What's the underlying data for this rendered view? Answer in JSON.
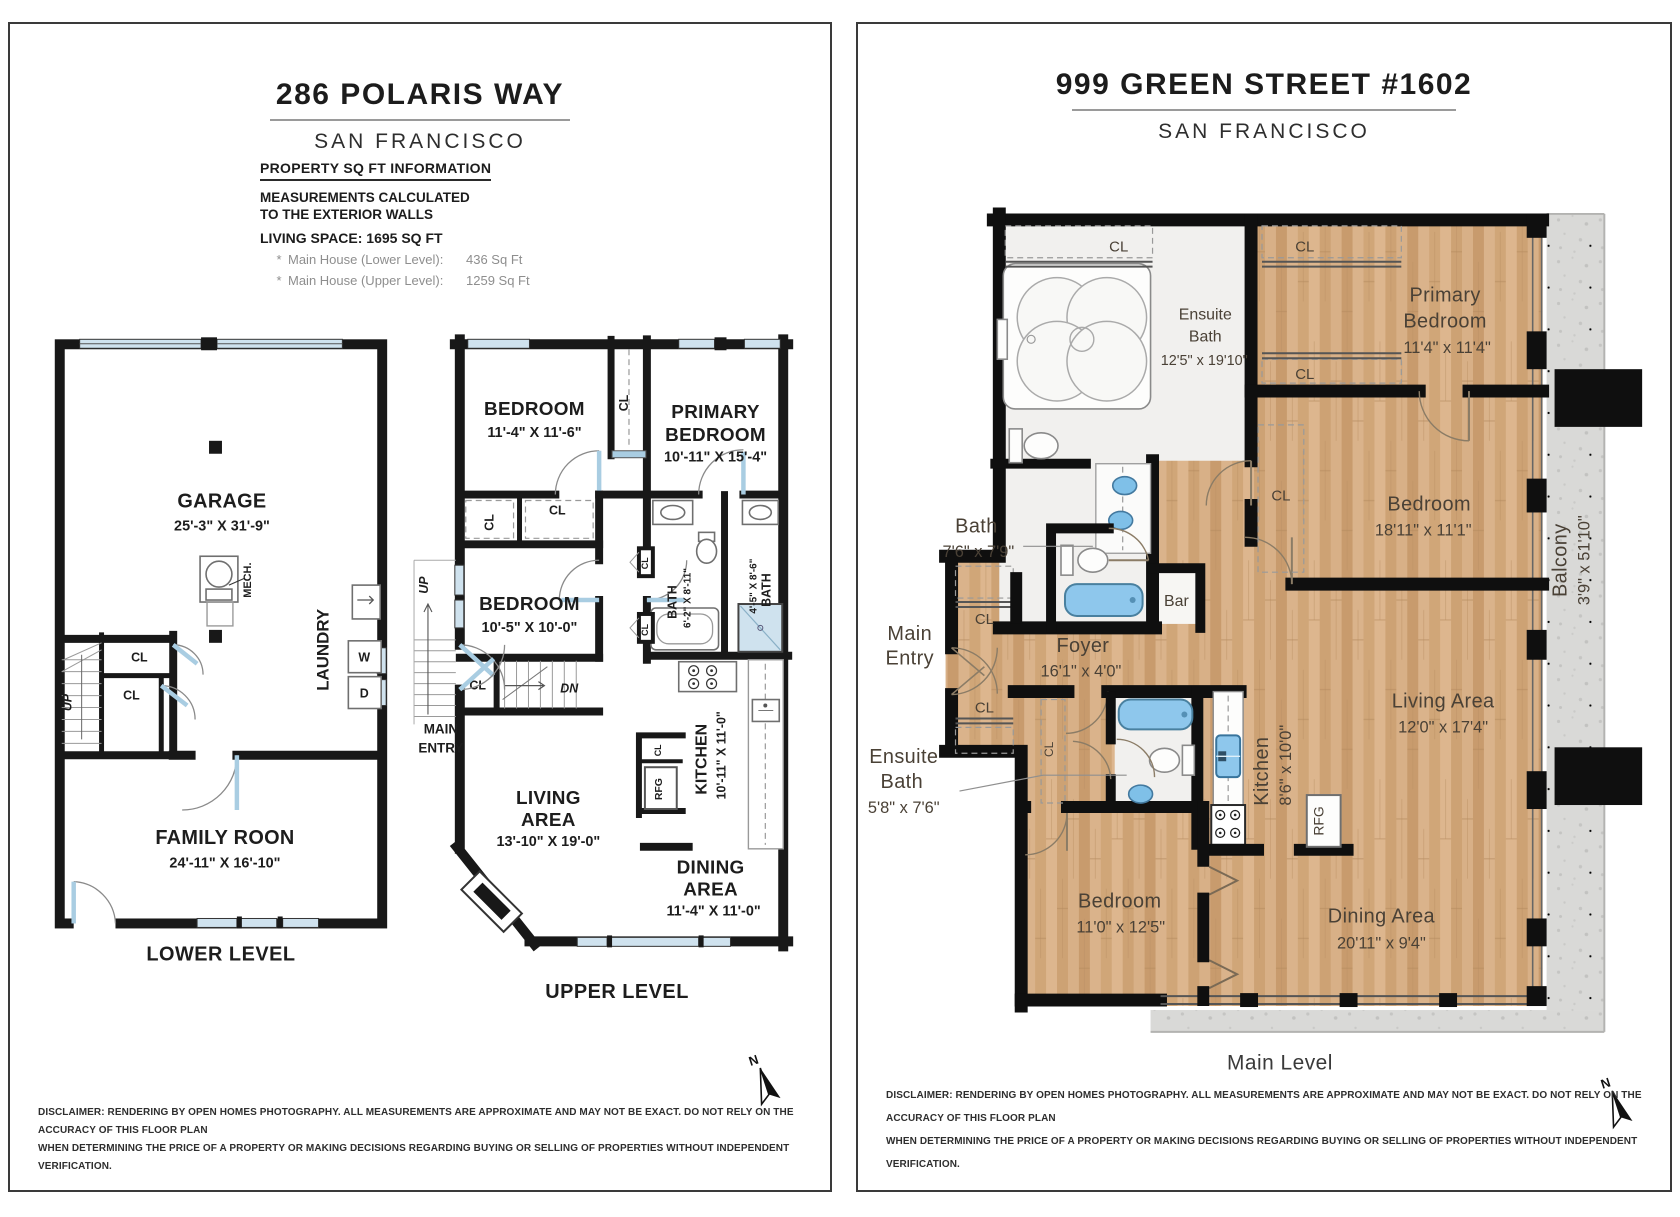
{
  "left": {
    "title": "286 POLARIS WAY",
    "city": "SAN FRANCISCO",
    "info": {
      "heading": "PROPERTY SQ FT INFORMATION",
      "m1": "MEASUREMENTS CALCULATED",
      "m2": "TO THE EXTERIOR WALLS",
      "living": "LIVING SPACE: 1695 SQ FT",
      "b1": "*",
      "l1": "Main House (Lower Level):",
      "v1": "436 Sq Ft",
      "b2": "*",
      "l2": "Main House (Upper Level):",
      "v2": "1259 Sq Ft"
    },
    "cl": "CL",
    "up": "UP",
    "dn": "DN",
    "north": "N",
    "lower": {
      "label": "LOWER LEVEL",
      "garage": "GARAGE",
      "garage_dims": "25'-3\" X 31'-9\"",
      "mech": "MECH.",
      "laundry": "LAUNDRY",
      "w": "W",
      "d": "D",
      "family": "FAMILY ROON",
      "family_dims": "24'-11\" X 16'-10\""
    },
    "upper": {
      "label": "UPPER LEVEL",
      "bed1": "BEDROOM",
      "bed1_dims": "11'-4\" X 11'-6\"",
      "primary1": "PRIMARY",
      "primary2": "BEDROOM",
      "primary_dims": "10'-11\" X 15'-4\"",
      "bed2": "BEDROOM",
      "bed2_dims": "10'-5\" X 10'-0\"",
      "bath1": "BATH",
      "bath1_dims": "6'-2\" X 8'-11\"",
      "bath2": "BATH",
      "bath2_dims": "4'-5\" X 8'-6\"",
      "main1": "MAIN",
      "main2": "ENTRY",
      "living1": "LIVING",
      "living2": "AREA",
      "living_dims": "13'-10\" X 19'-0\"",
      "kitchen": "KITCHEN",
      "kitchen_dims": "10'-11\" X 11'-0\"",
      "rfg": "RFG",
      "dining1": "DINING",
      "dining2": "AREA",
      "dining_dims": "11'-4\" X 11'-0\""
    },
    "disc1": "DISCLAIMER: RENDERING BY OPEN HOMES PHOTOGRAPHY. ALL MEASUREMENTS ARE APPROXIMATE AND MAY NOT BE EXACT. DO NOT RELY ON THE ACCURACY OF THIS FLOOR PLAN",
    "disc2": "WHEN DETERMINING THE PRICE OF A PROPERTY OR MAKING DECISIONS REGARDING BUYING OR SELLING OF PROPERTIES WITHOUT INDEPENDENT VERIFICATION."
  },
  "right": {
    "title": "999 GREEN STREET #1602",
    "city": "SAN FRANCISCO",
    "cl": "CL",
    "north": "N",
    "level": "Main Level",
    "rooms": {
      "ensuite1a": "Ensuite",
      "ensuite1b": "Bath",
      "ensuite1_dims": "12'5\" x 19'10\"",
      "primary1": "Primary",
      "primary2": "Bedroom",
      "primary_dims": "11'4\" x 11'4\"",
      "bed1": "Bedroom",
      "bed1_dims": "18'11\" x 11'1\"",
      "bath": "Bath",
      "bath_dims": "7'6\" x 7'9\"",
      "bar": "Bar",
      "main1": "Main",
      "main2": "Entry",
      "foyer": "Foyer",
      "foyer_dims": "16'1\" x 4'0\"",
      "ensuite2a": "Ensuite",
      "ensuite2b": "Bath",
      "ensuite2_dims": "5'8\" x 7'6\"",
      "kitchen": "Kitchen",
      "kitchen_dims": "8'6\" x 10'0\"",
      "rfg": "RFG",
      "living": "Living Area",
      "living_dims": "12'0\" x 17'4\"",
      "dining": "Dining Area",
      "dining_dims": "20'11\" x 9'4\"",
      "bed2": "Bedroom",
      "bed2_dims": "11'0\" x 12'5\"",
      "balcony": "Balcony",
      "balcony_dims": "3'9\" x 51'10\""
    },
    "disc1": "DISCLAIMER: RENDERING BY OPEN HOMES PHOTOGRAPHY. ALL MEASUREMENTS ARE APPROXIMATE AND MAY NOT BE EXACT. DO NOT RELY ON THE ACCURACY OF THIS FLOOR PLAN",
    "disc2": "WHEN DETERMINING THE PRICE OF A PROPERTY OR MAKING DECISIONS REGARDING BUYING OR SELLING OF PROPERTIES WITHOUT INDEPENDENT VERIFICATION."
  }
}
